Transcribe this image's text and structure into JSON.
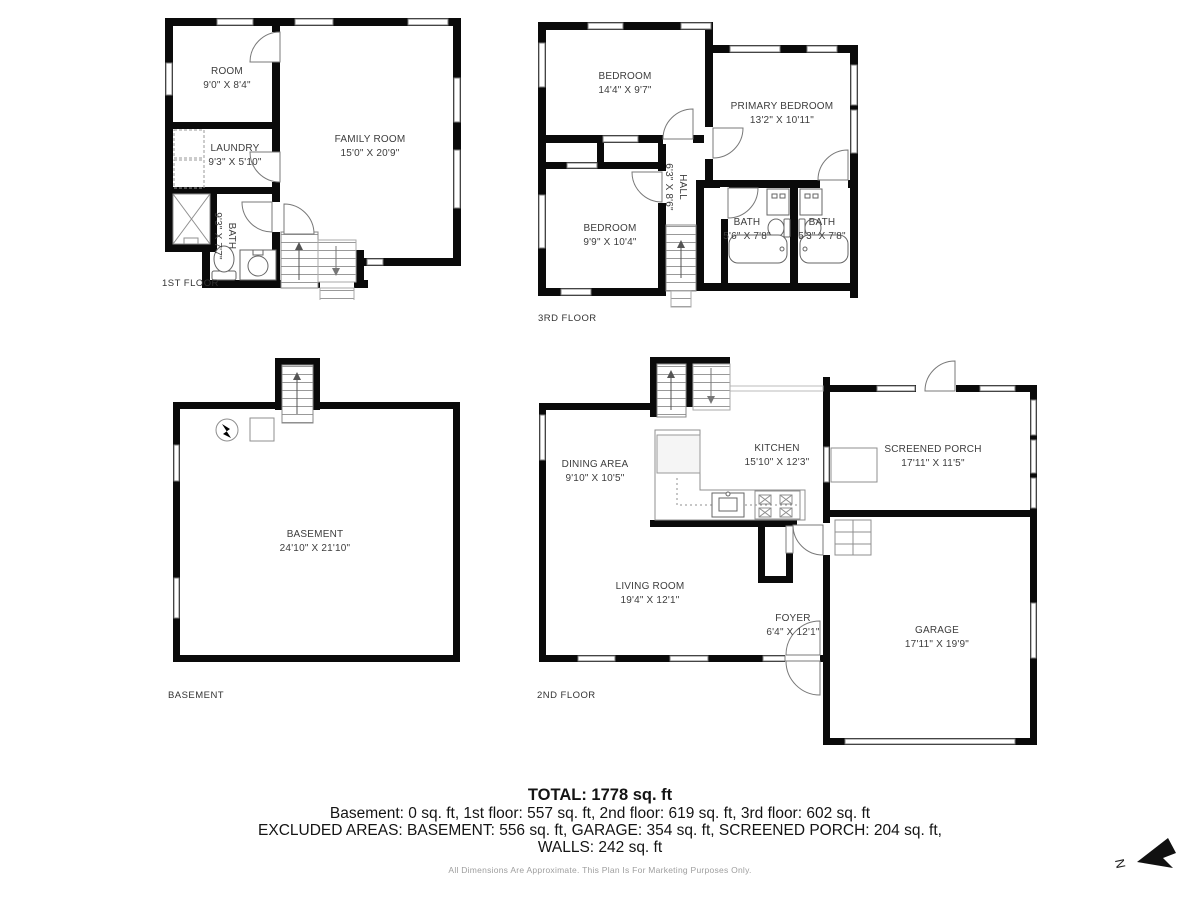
{
  "colors": {
    "wall": "#0a0a0a",
    "thin_line": "#8f8f8f",
    "room_text": "#3d3d3d",
    "summary_text": "#141414",
    "disclaimer_text": "#9e9e9e"
  },
  "floors": {
    "first": {
      "label": "1ST FLOOR",
      "rooms": {
        "room": {
          "name": "ROOM",
          "dims": "9'0\" X 8'4\""
        },
        "laundry": {
          "name": "LAUNDRY",
          "dims": "9'3\" X 5'10\""
        },
        "bath": {
          "name": "BATH",
          "dims": "9'3\" X 7'7\""
        },
        "family": {
          "name": "FAMILY ROOM",
          "dims": "15'0\" X 20'9\""
        }
      }
    },
    "third": {
      "label": "3RD FLOOR",
      "rooms": {
        "bedroom1": {
          "name": "BEDROOM",
          "dims": "14'4\" X 9'7\""
        },
        "primary": {
          "name": "PRIMARY BEDROOM",
          "dims": "13'2\" X 10'11\""
        },
        "hall": {
          "name": "HALL",
          "dims": "6'3\" X 8'6\""
        },
        "bedroom2": {
          "name": "BEDROOM",
          "dims": "9'9\" X 10'4\""
        },
        "bath1": {
          "name": "BATH",
          "dims": "5'6\" X 7'8\""
        },
        "bath2": {
          "name": "BATH",
          "dims": "5'3\" X 7'8\""
        }
      }
    },
    "basement": {
      "label": "BASEMENT",
      "rooms": {
        "basement": {
          "name": "BASEMENT",
          "dims": "24'10\" X 21'10\""
        }
      }
    },
    "second": {
      "label": "2ND FLOOR",
      "rooms": {
        "dining": {
          "name": "DINING AREA",
          "dims": "9'10\" X 10'5\""
        },
        "kitchen": {
          "name": "KITCHEN",
          "dims": "15'10\" X 12'3\""
        },
        "porch": {
          "name": "SCREENED PORCH",
          "dims": "17'11\" X 11'5\""
        },
        "living": {
          "name": "LIVING ROOM",
          "dims": "19'4\" X 12'1\""
        },
        "foyer": {
          "name": "FOYER",
          "dims": "6'4\" X 12'1\""
        },
        "garage": {
          "name": "GARAGE",
          "dims": "17'11\" X 19'9\""
        }
      }
    }
  },
  "summary": {
    "total": "TOTAL: 1778 sq. ft",
    "floors_line": "Basement: 0 sq. ft, 1st floor: 557 sq. ft, 2nd floor: 619 sq. ft, 3rd floor: 602 sq. ft",
    "excluded_line": "EXCLUDED AREAS: BASEMENT: 556 sq. ft, GARAGE: 354 sq. ft, SCREENED PORCH: 204 sq. ft,",
    "walls_line": "WALLS: 242 sq. ft",
    "disclaimer": "All Dimensions Are Approximate. This Plan Is For Marketing Purposes Only."
  },
  "compass": {
    "north_label": "N"
  }
}
